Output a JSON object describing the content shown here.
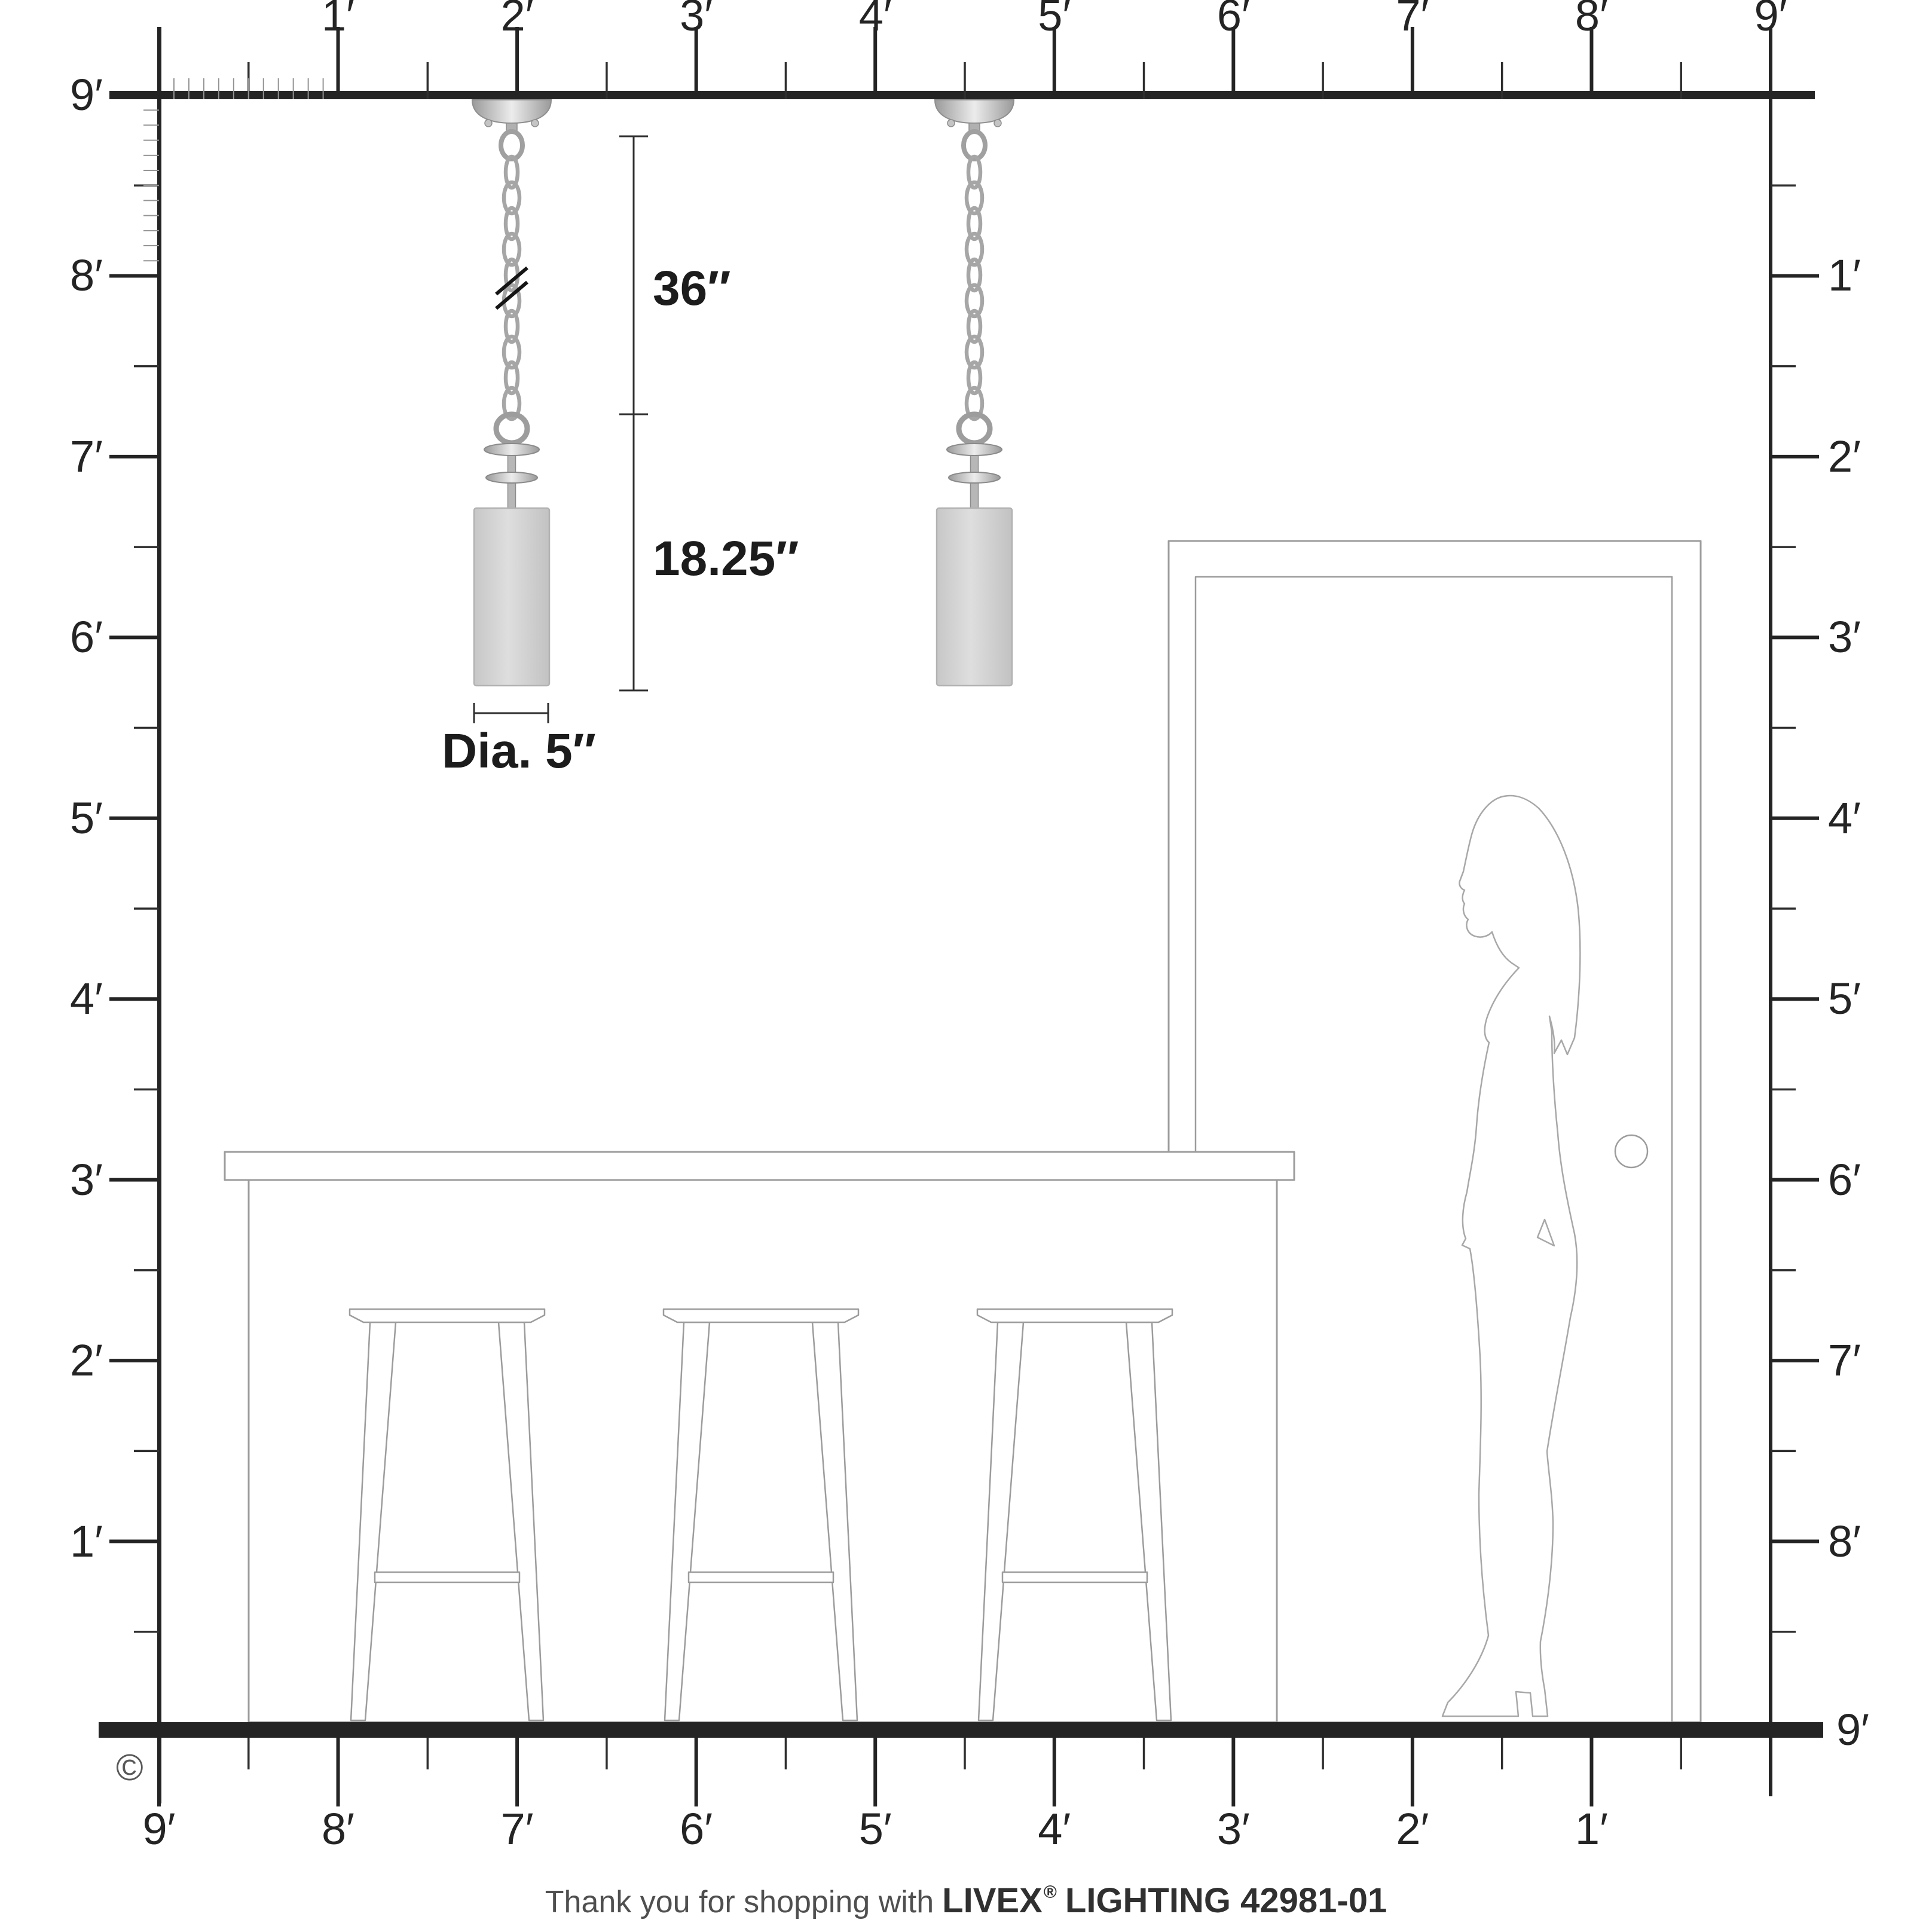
{
  "rulers": {
    "top": [
      "1′",
      "2′",
      "3′",
      "4′",
      "5′",
      "6′",
      "7′",
      "8′",
      "9′"
    ],
    "left": [
      "9′",
      "8′",
      "7′",
      "6′",
      "5′",
      "4′",
      "3′",
      "2′",
      "1′"
    ],
    "right": [
      "1′",
      "2′",
      "3′",
      "4′",
      "5′",
      "6′",
      "7′",
      "8′"
    ],
    "right_floor_label": "9′",
    "bottom": [
      "9′",
      "8′",
      "7′",
      "6′",
      "5′",
      "4′",
      "3′",
      "2′",
      "1′"
    ],
    "unit": "feet",
    "room_height_feet": 9,
    "room_width_feet": 9
  },
  "dimensions": {
    "chain_length": "36″",
    "fixture_height": "18.25″",
    "shade_diameter": "Dia. 5″"
  },
  "footer": {
    "message": "Thank you for shopping with",
    "brand": "LIVEX",
    "registered_mark": "®",
    "product": "LIGHTING 42981-01"
  },
  "copyright_symbol": "©",
  "scene_objects": {
    "pendant_count": 2,
    "stool_count": 3,
    "has_door": true,
    "has_woman_figure": true
  },
  "colors": {
    "line_dark": "#242424",
    "line_mid": "#2e2e2e",
    "line_gray": "#9c9c9c",
    "figure_gray": "#a8a8a8",
    "inch_tick_gray": "#949494",
    "dim_line": "#2f2f2f",
    "text_dark": "#1c1c1c",
    "footer_gray": "#4f4f4f",
    "metal_gray": "#a6a6a6",
    "shade_gray": "#d6d6d6"
  }
}
